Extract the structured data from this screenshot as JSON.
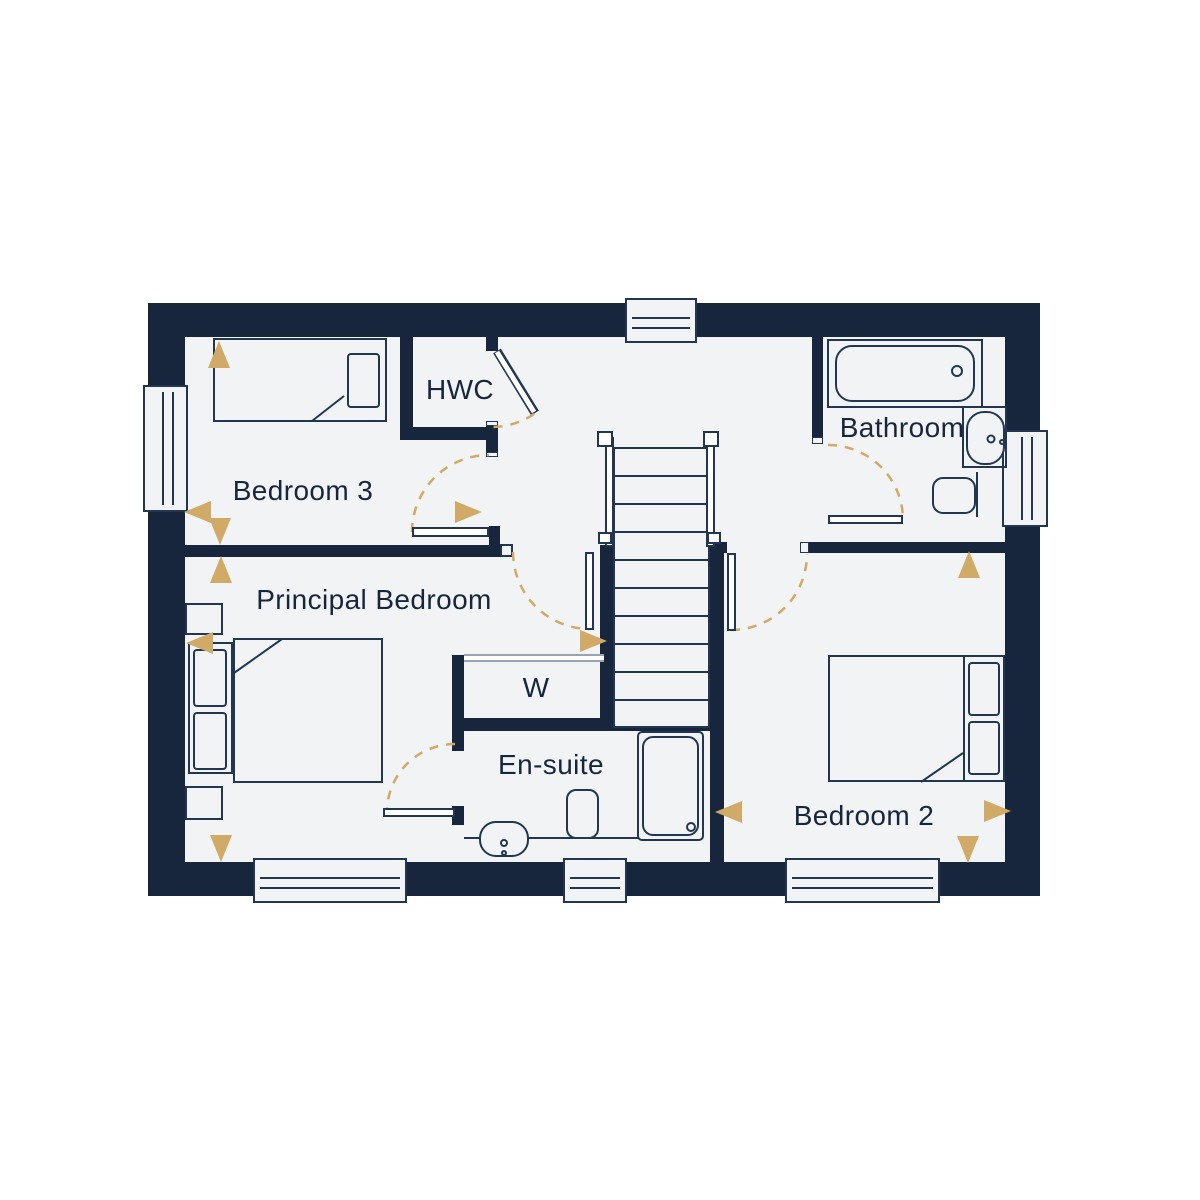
{
  "colors": {
    "wall": "#17263c",
    "line": "#22374f",
    "floor": "#f2f3f4",
    "outside": "#ffffff",
    "accent": "#d0aa66",
    "rail": "#9aa4b0"
  },
  "rooms": {
    "bedroom3": {
      "label": "Bedroom 3"
    },
    "hwc": {
      "label": "HWC"
    },
    "bathroom": {
      "label": "Bathroom"
    },
    "principal_bedroom": {
      "label": "Principal Bedroom"
    },
    "wardrobe": {
      "label": "W"
    },
    "ensuite": {
      "label": "En-suite"
    },
    "bedroom2": {
      "label": "Bedroom 2"
    }
  },
  "icons": [
    "single-bed-icon",
    "double-bed-icon",
    "bath-tub-icon",
    "sink-icon",
    "toilet-icon",
    "shower-icon",
    "staircase-icon",
    "window-icon",
    "door-swing-icon",
    "direction-arrow-icon",
    "wardrobe-doors-icon"
  ]
}
